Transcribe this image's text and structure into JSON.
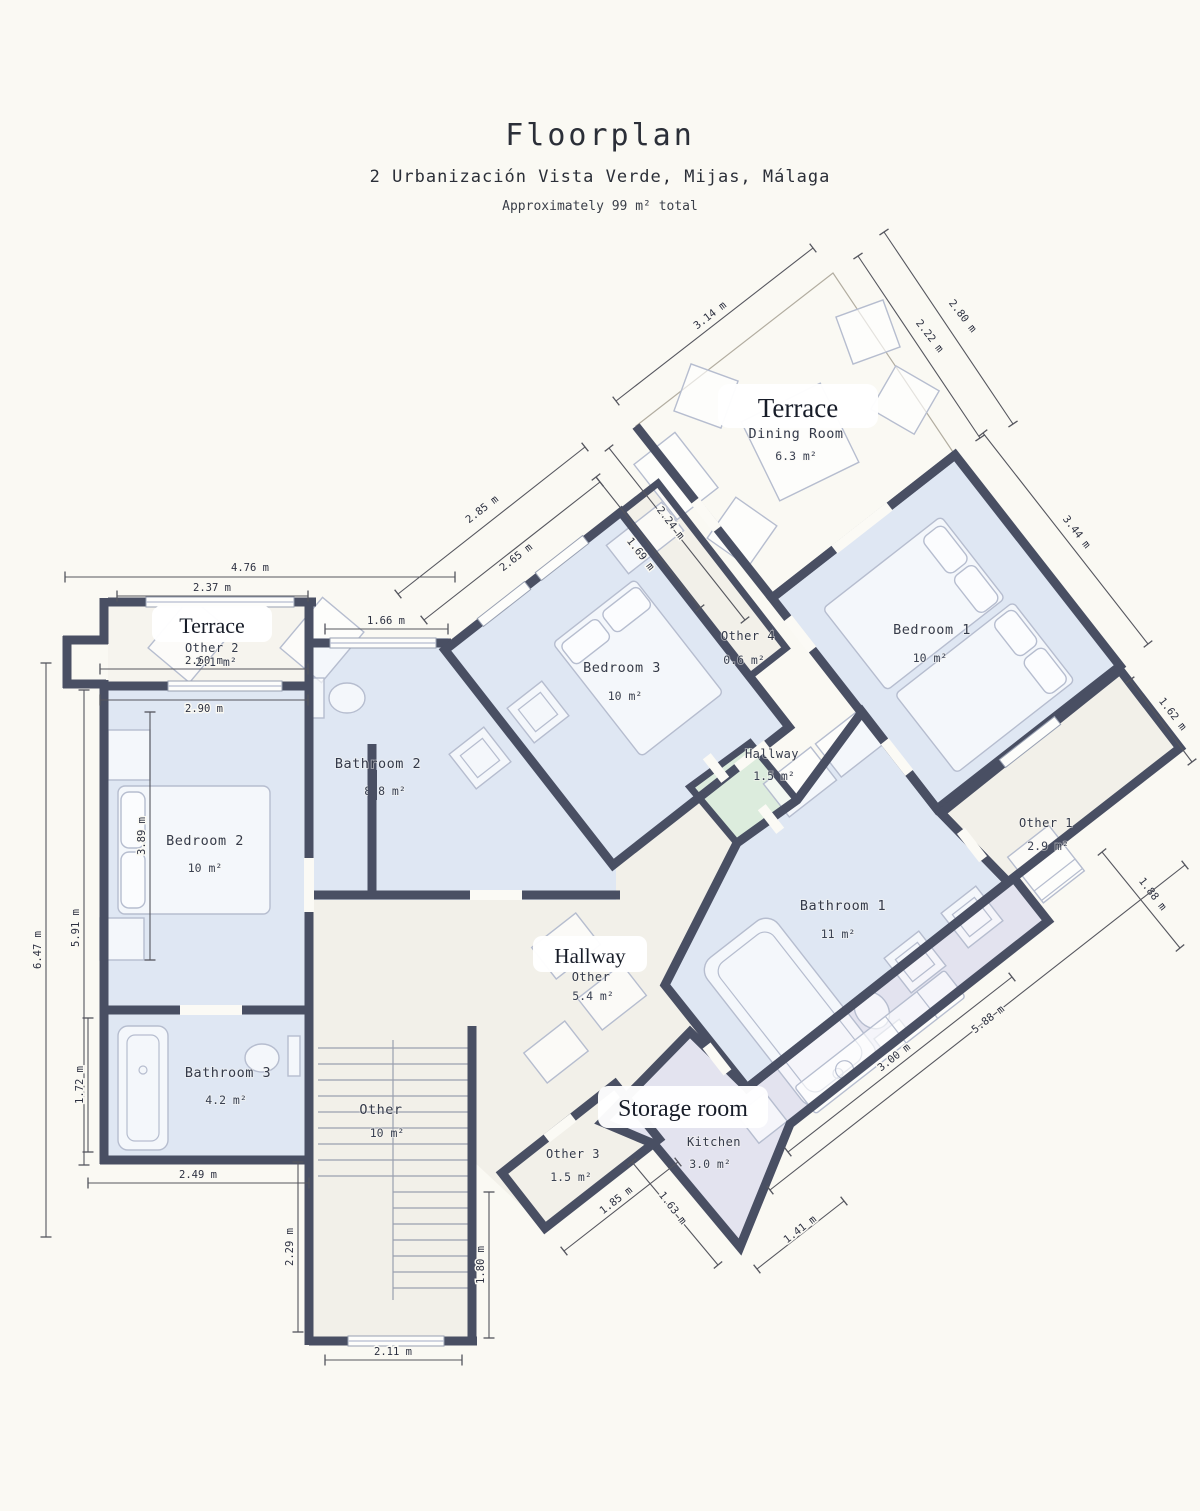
{
  "header": {
    "title": "Floorplan",
    "address": "2 Urbanización Vista Verde, Mijas, Málaga",
    "note": "Approximately 99 m² total"
  },
  "rooms": {
    "terrace_top": {
      "badge": "Terrace",
      "name": "Dining Room",
      "area": "6.3 m²"
    },
    "terrace_left": {
      "badge": "Terrace",
      "name": "Other 2",
      "area": "2.1 m²"
    },
    "bedroom1": {
      "name": "Bedroom 1",
      "area": "10 m²"
    },
    "bedroom2": {
      "name": "Bedroom 2",
      "area": "10 m²"
    },
    "bedroom3": {
      "name": "Bedroom 3",
      "area": "10 m²"
    },
    "bathroom1": {
      "name": "Bathroom 1",
      "area": "11 m²"
    },
    "bathroom2": {
      "name": "Bathroom 2",
      "area": "8.8 m²"
    },
    "bathroom3": {
      "name": "Bathroom 3",
      "area": "4.2 m²"
    },
    "hallway_small": {
      "name": "Hallway",
      "area": "1.5 m²"
    },
    "hallway_main": {
      "badge": "Hallway",
      "name": "Other",
      "area": "5.4 m²"
    },
    "storage": {
      "badge": "Storage room",
      "name": "Kitchen",
      "area": "3.0 m²"
    },
    "stairs": {
      "name": "Other",
      "area": "10 m²"
    },
    "other1": {
      "name": "Other 1",
      "area": "2.9 m²"
    },
    "other3": {
      "name": "Other 3",
      "area": "1.5 m²"
    },
    "other4": {
      "name": "Other 4",
      "area": "0.6 m²"
    }
  },
  "dims": {
    "terrace_top_edge": "3.14 m",
    "terrace_right_inner": "2.22 m",
    "terrace_right_outer": "2.80 m",
    "terrace_left_upper": "2.24 m",
    "terrace_left_lower": "1.69 m",
    "bedroom3_outer": "2.85 m",
    "bedroom3_inner": "2.65 m",
    "bathroom2_top": "1.66 m",
    "left_top_outer": "4.76 m",
    "terrace2_width": "2.37 m",
    "terrace2_inner": "2.60 m",
    "bedroom2_width": "2.90 m",
    "left_outer": "6.47 m",
    "left_mid": "5.91 m",
    "bedroom2_height": "3.89 m",
    "bathroom3_height": "1.72 m",
    "bathroom3_width": "2.49 m",
    "stairs_left": "2.29 m",
    "stairs_right": "1.80 m",
    "stairs_width": "2.11 m",
    "bedroom1_right": "3.44 m",
    "bedroom1_corner": "1.62 m",
    "other1_bottom": "1.88 m",
    "southeast_outer": "5.88 m",
    "southeast_inner": "3.00 m",
    "other3_edge": "1.85 m",
    "kitchen_left": "1.63 m",
    "kitchen_right": "1.41 m"
  },
  "colors": {
    "wall": "#494f63",
    "room_blue": "#dfe7f3",
    "room_cream": "#f2f0e9",
    "terrace_tan": "#dcd0c0",
    "storage_lavender": "#e3e3ef",
    "hallway_green": "#dcecdd",
    "background": "#faf9f3"
  }
}
